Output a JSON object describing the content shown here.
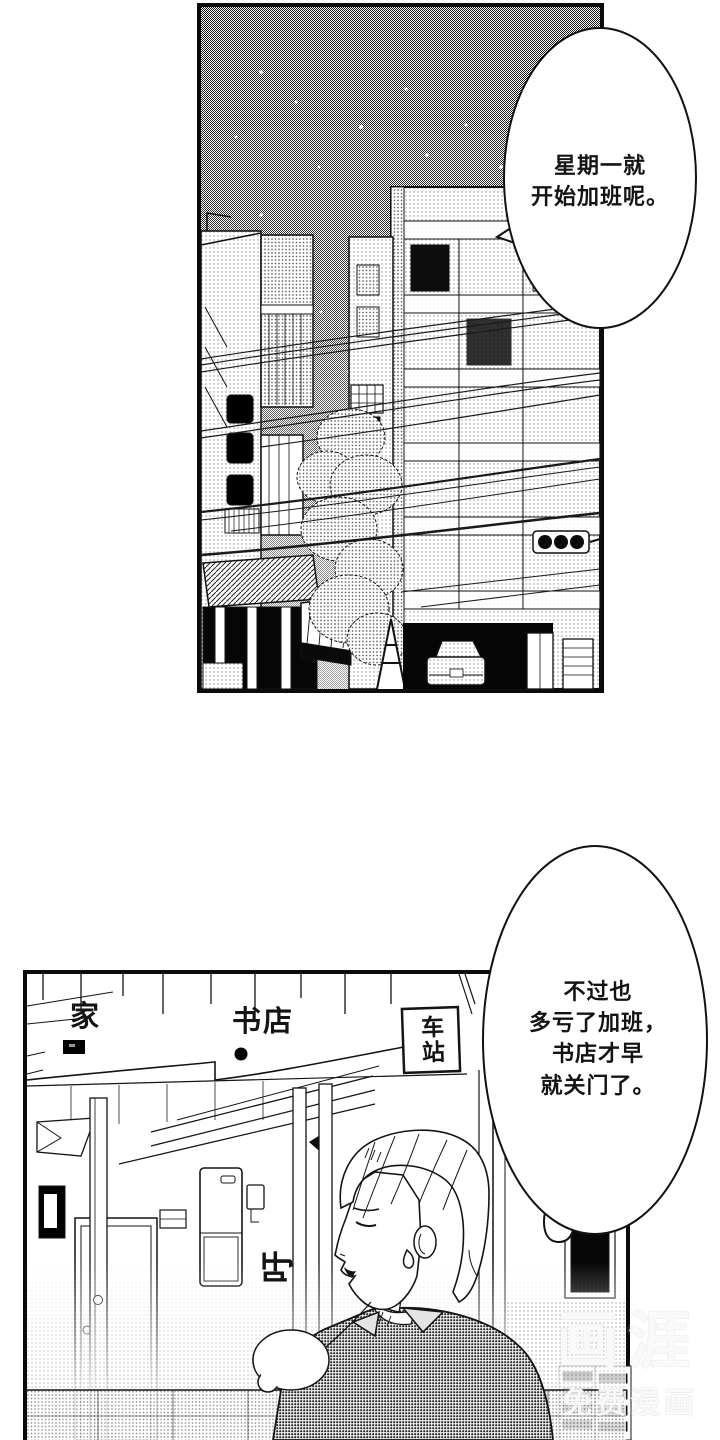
{
  "comic": {
    "bubble1": {
      "lines": [
        "星期一就",
        "开始加班呢。"
      ]
    },
    "bubble2": {
      "lines": [
        "不过也",
        "多亏了加班，",
        "书店才早",
        "就关门了。"
      ]
    },
    "map": {
      "home": "家",
      "bookstore": "书店",
      "station": "车站"
    },
    "sfx": {
      "sigh": "吁"
    },
    "watermark": {
      "brand": "画涯",
      "tagline": "免费漫画"
    },
    "colors": {
      "ink": "#141414",
      "paper": "#ffffff"
    }
  }
}
